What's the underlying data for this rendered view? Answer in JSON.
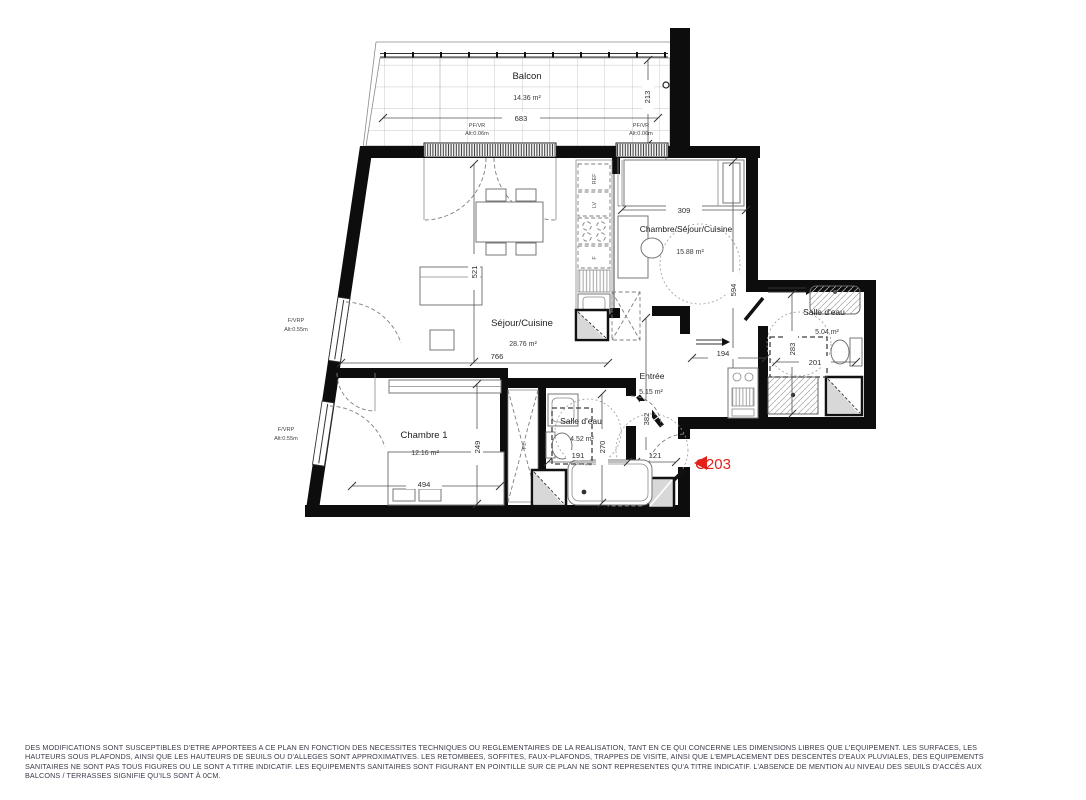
{
  "meta": {
    "type": "apartment-floor-plan",
    "accent_red": "#e32119"
  },
  "unit_tag": {
    "label": "C203"
  },
  "balcon": {
    "name": "Balcon",
    "area": "14.36 m²",
    "dim_width": "683",
    "dim_depth": "213"
  },
  "sejour": {
    "name": "Séjour/Cuisine",
    "area": "28.76 m²",
    "dim_width": "766",
    "dim_height": "521"
  },
  "chambre_sejour": {
    "name": "Chambre/Séjour/Cuisine",
    "area": "15.88 m²",
    "dim_width": "309",
    "dim_height": "594"
  },
  "chambre1": {
    "name": "Chambre 1",
    "area": "12.16 m²",
    "dim_width": "494",
    "dim_height": "249"
  },
  "sde_centre": {
    "name": "Salle d'eau",
    "area": "4.52 m²",
    "dim_width": "191",
    "dim_height": "270"
  },
  "sde_droite": {
    "name": "Salle d'eau",
    "area": "5.04 m²",
    "dim_width": "201",
    "dim_height": "283"
  },
  "entree": {
    "name": "Entrée",
    "area": "5.15 m²",
    "dim_height": "382",
    "dim_width": "121",
    "dim_corridor": "194"
  },
  "windows": {
    "pfvr": {
      "label": "PF/VR",
      "alt": "Alt:0.06m"
    },
    "fvrp": {
      "label": "F/VRP",
      "alt": "Alt:0.55m"
    }
  },
  "equipment": {
    "fridge": "REF",
    "dishwasher": "LV",
    "oven": "F",
    "closet": "PL"
  },
  "disclaimer": {
    "line1": "DES MODIFICATIONS SONT SUSCEPTIBLES D'ETRE APPORTEES A CE PLAN EN FONCTION DES NECESSITES TECHNIQUES OU REGLEMENTAIRES DE LA REALISATION, TANT EN CE QUI CONCERNE LES DIMENSIONS LIBRES QUE L'EQUIPEMENT. LES SURFACES, LES",
    "line2": "HAUTEURS SOUS PLAFONDS, AINSI QUE LES HAUTEURS DE SEUILS OU D'ALLEGES SONT APPROXIMATIVES. LES RETOMBEES, SOFFITES, FAUX-PLAFONDS, TRAPPES DE VISITE, AINSI QUE L'EMPLACEMENT DES DESCENTES D'EAUX PLUVIALES, DES EQUIPEMENTS",
    "line3": "SANITAIRES NE SONT PAS TOUS FIGURES OU LE SONT A TITRE INDICATIF. LES EQUIPEMENTS SANITAIRES SONT FIGURANT EN POINTILLE SUR CE PLAN NE SONT REPRESENTES QU'A TITRE INDICATIF. L'ABSENCE DE MENTION AU NIVEAU DES SEUILS D'ACCÈS AUX",
    "line4": "BALCONS / TERRASSES SIGNIFIE QU'ILS SONT À 0CM."
  }
}
